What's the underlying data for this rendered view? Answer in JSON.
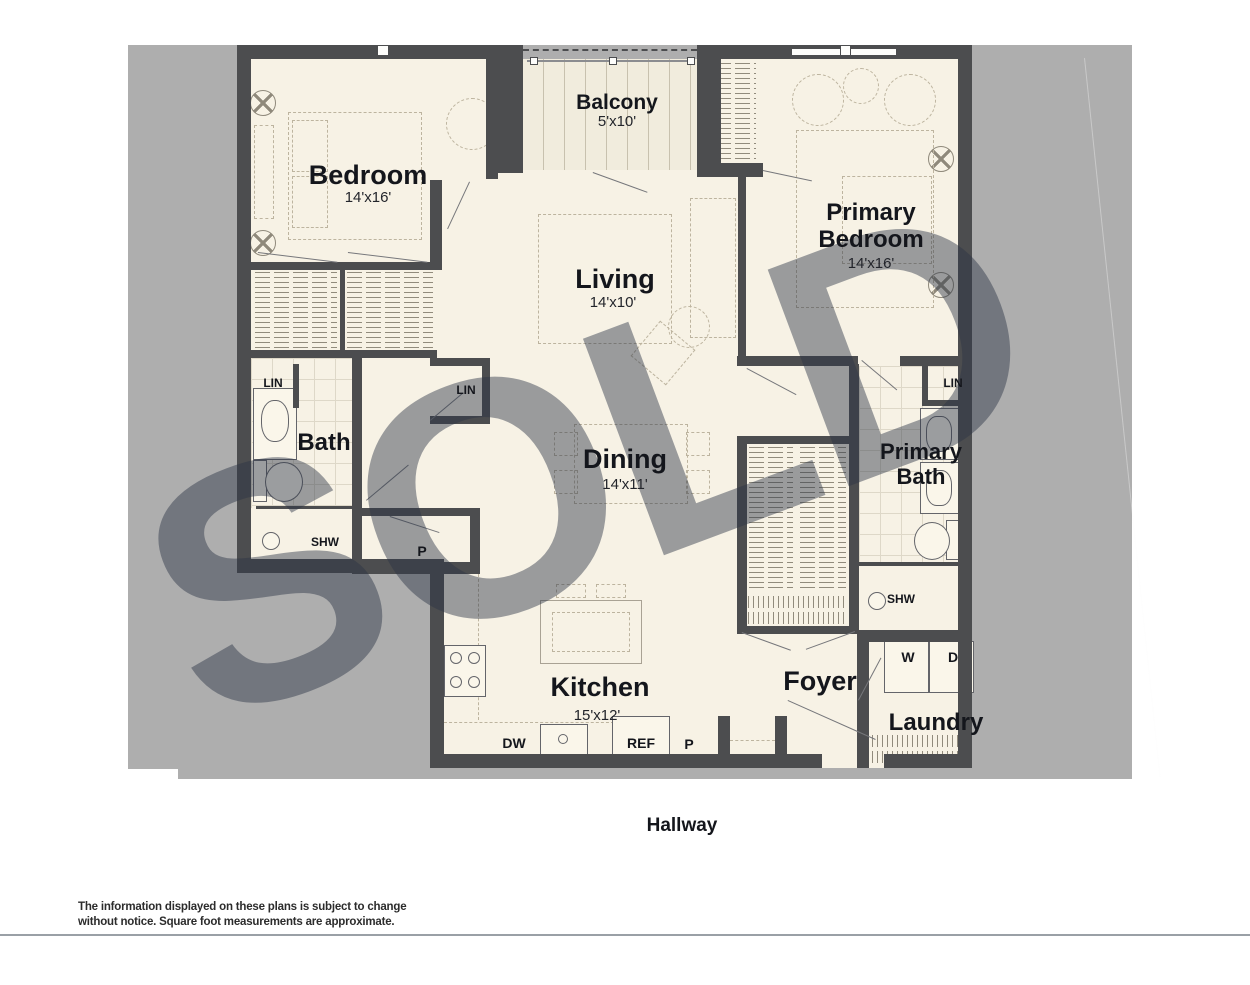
{
  "watermark": {
    "text": "SOLD"
  },
  "rooms": {
    "bedroom": {
      "label": "Bedroom",
      "dims": "14'x16'"
    },
    "balcony": {
      "label": "Balcony",
      "dims": "5'x10'"
    },
    "living": {
      "label": "Living",
      "dims": "14'x10'"
    },
    "primary_bedroom": {
      "label": "Primary Bedroom",
      "dims": "14'x16'"
    },
    "dining": {
      "label": "Dining",
      "dims": "14'x11'"
    },
    "kitchen": {
      "label": "Kitchen",
      "dims": "15'x12'"
    },
    "bath": {
      "label": "Bath"
    },
    "primary_bath": {
      "label": "Primary Bath"
    },
    "foyer": {
      "label": "Foyer"
    },
    "laundry": {
      "label": "Laundry"
    },
    "hallway": {
      "label": "Hallway"
    }
  },
  "fixture_labels": {
    "linen": "LIN",
    "shower": "SHW",
    "pantry": "P",
    "dishwasher": "DW",
    "refrigerator": "REF",
    "washer": "W",
    "dryer": "D"
  },
  "footer": {
    "disclaimer": "The information displayed on these plans is subject to change without notice. Square foot measurements are approximate."
  },
  "colors": {
    "backdrop": "#aeaeae",
    "wall": "#4c4d4f",
    "floor": "#f7f2e5",
    "watermark": "rgba(44,52,70,0.46)"
  }
}
